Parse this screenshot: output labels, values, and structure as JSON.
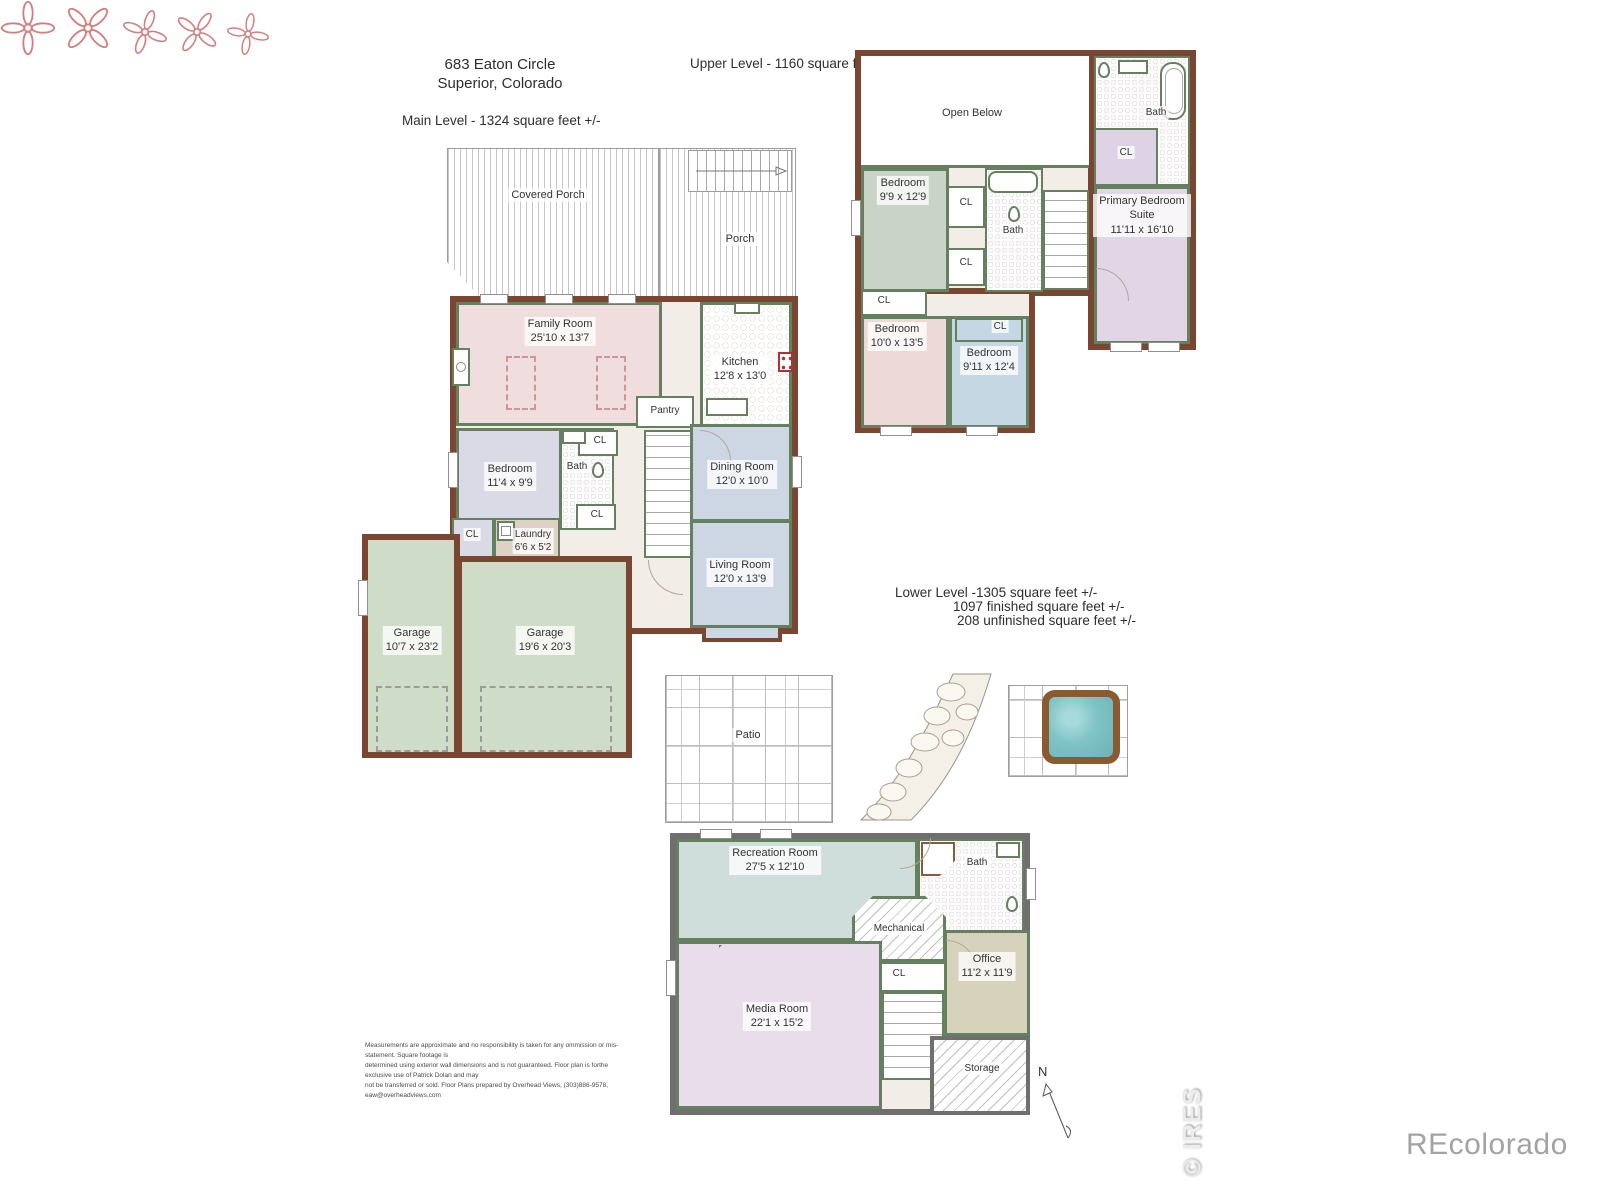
{
  "header": {
    "address_line1": "683 Eaton Circle",
    "address_line2": "Superior, Colorado"
  },
  "levels": {
    "main": {
      "label": "Main Level - 1324 square feet +/-",
      "rooms": {
        "covered_porch": {
          "name": "Covered Porch"
        },
        "porch": {
          "name": "Porch"
        },
        "family_room": {
          "name": "Family Room",
          "dims": "25'10 x 13'7"
        },
        "kitchen": {
          "name": "Kitchen",
          "dims": "12'8 x 13'0"
        },
        "pantry": {
          "name": "Pantry"
        },
        "bedroom": {
          "name": "Bedroom",
          "dims": "11'4 x 9'9"
        },
        "bath": {
          "name": "Bath"
        },
        "cl_upper": {
          "name": "CL"
        },
        "cl_lower": {
          "name": "CL"
        },
        "cl_garage": {
          "name": "CL"
        },
        "laundry": {
          "name": "Laundry",
          "dims": "6'6 x 5'2"
        },
        "dining_room": {
          "name": "Dining Room",
          "dims": "12'0 x 10'0"
        },
        "living_room": {
          "name": "Living Room",
          "dims": "12'0 x 13'9"
        },
        "garage_small": {
          "name": "Garage",
          "dims": "10'7 x 23'2"
        },
        "garage_large": {
          "name": "Garage",
          "dims": "19'6 x 20'3"
        }
      }
    },
    "upper": {
      "label": "Upper Level - 1160 square feet +/-",
      "rooms": {
        "open_below": {
          "name": "Open Below"
        },
        "bath_primary": {
          "name": "Bath"
        },
        "cl_primary": {
          "name": "CL"
        },
        "primary_suite": {
          "name": "Primary Bedroom Suite",
          "dims": "11'11 x 16'10"
        },
        "bedroom_a": {
          "name": "Bedroom",
          "dims": "9'9 x 12'9"
        },
        "cl_hall_a": {
          "name": "CL"
        },
        "bath_hall": {
          "name": "Bath"
        },
        "cl_hall_b": {
          "name": "CL"
        },
        "cl_bedroom_b": {
          "name": "CL"
        },
        "bedroom_b": {
          "name": "Bedroom",
          "dims": "10'0 x 13'5"
        },
        "cl_bedroom_c": {
          "name": "CL"
        },
        "bedroom_c": {
          "name": "Bedroom",
          "dims": "9'11 x 12'4"
        }
      }
    },
    "lower": {
      "label_line1": "Lower Level -1305 square feet +/-",
      "label_line2": "1097 finished square feet +/-",
      "label_line3": "208 unfinished square feet +/-",
      "rooms": {
        "patio": {
          "name": "Patio"
        },
        "recreation_room": {
          "name": "Recreation Room",
          "dims": "27'5 x 12'10"
        },
        "bath": {
          "name": "Bath"
        },
        "mechanical": {
          "name": "Mechanical"
        },
        "cl": {
          "name": "CL"
        },
        "office": {
          "name": "Office",
          "dims": "11'2 x 11'9"
        },
        "media_room": {
          "name": "Media Room",
          "dims": "22'1 x 15'2"
        },
        "storage": {
          "name": "Storage"
        }
      }
    }
  },
  "compass": {
    "label": "N"
  },
  "footer": {
    "disclaimer_line1": "Measurements  are approximate and no responsibility is taken for any ommission or mis-statement.   Square footage is",
    "disclaimer_line2": "determined using exterior wall dimensions and is not guaranteed.   Floor plan is forthe exclusive use of  Patrick Dolan and may",
    "disclaimer_line3": "not be transferred or sold. Floor Plans prepared by Overhead Views, (303)886-9578, eaw@overheadviews.com"
  },
  "watermarks": {
    "ires": "© IRES",
    "recolorado": "REcolorado"
  },
  "colors": {
    "exterior_wall_brown": "#7a4631",
    "interior_wall_green": "#64805f",
    "lower_exterior_wall_gray": "#6f6f6f",
    "family_room_pink": "#f0dede",
    "bedroom_lavender": "#dadae7",
    "dining_living_blue": "#ccd7e3",
    "garage_sage": "#cfdcc8",
    "laundry_taupe": "#ded2c6",
    "upper_bedroom_sage": "#c9d3c8",
    "upper_bedroom_pink": "#eddad8",
    "upper_bedroom_blue": "#c5d7e3",
    "primary_lavender": "#e2d6e6",
    "recreation_teal": "#cfdeda",
    "media_lilac": "#e9ddeb",
    "office_tan": "#d6d2bb",
    "hot_tub_water": "#7fc3c5",
    "hot_tub_rim": "#8a5a30",
    "ceiling_fan_red": "#d27f7f"
  }
}
